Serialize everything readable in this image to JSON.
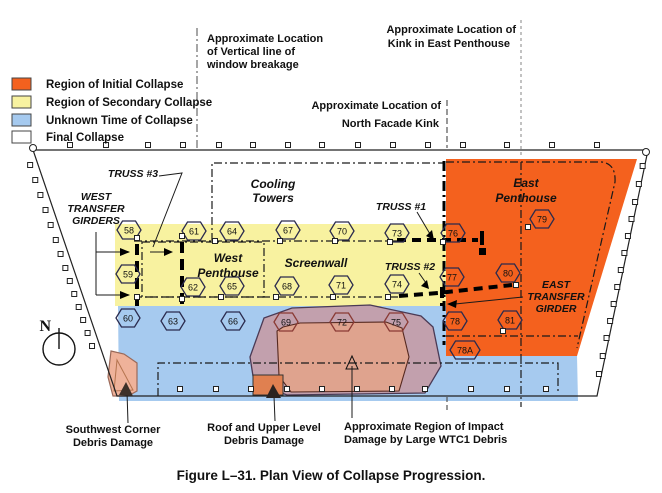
{
  "figure": {
    "caption": "Figure L–31.  Plan View of Collapse Progression."
  },
  "legend": {
    "items": [
      {
        "label": "Region of Initial Collapse",
        "color": "#F4611E"
      },
      {
        "label": "Region of Secondary Collapse",
        "color": "#F8F2A0"
      },
      {
        "label": "Unknown Time of Collapse",
        "color": "#A6CAEF"
      },
      {
        "label": "Final Collapse",
        "color": "#FFFFFF"
      }
    ]
  },
  "annotations": {
    "window_breakage": {
      "line1": "Approximate Location",
      "line2": "of Vertical line of",
      "line3": "window breakage"
    },
    "east_penthouse_kink": {
      "line1": "Approximate Location of",
      "line2": "Kink in East Penthouse"
    },
    "north_facade_kink": {
      "line1": "Approximate Location of",
      "line2": "North Facade Kink"
    }
  },
  "building": {
    "areas": {
      "cooling_towers": {
        "line1": "Cooling",
        "line2": "Towers"
      },
      "west_penthouse": {
        "line1": "West",
        "line2": "Penthouse"
      },
      "screenwall": "Screenwall",
      "east_penthouse": {
        "line1": "East",
        "line2": "Penthouse"
      }
    },
    "trusses": {
      "t1": "TRUSS #1",
      "t2": "TRUSS #2",
      "t3": "TRUSS #3"
    },
    "west_girders": {
      "line1": "WEST",
      "line2": "TRANSFER",
      "line3": "GIRDERS"
    },
    "east_girder": {
      "line1": "EAST",
      "line2": "TRANSFER",
      "line3": "GIRDER"
    },
    "columns": [
      {
        "n": "58",
        "x": 129,
        "y": 230
      },
      {
        "n": "61",
        "x": 194,
        "y": 231
      },
      {
        "n": "64",
        "x": 232,
        "y": 231
      },
      {
        "n": "67",
        "x": 288,
        "y": 230
      },
      {
        "n": "70",
        "x": 342,
        "y": 231
      },
      {
        "n": "73",
        "x": 397,
        "y": 233
      },
      {
        "n": "76",
        "x": 453,
        "y": 233
      },
      {
        "n": "79",
        "x": 542,
        "y": 219
      },
      {
        "n": "59",
        "x": 128,
        "y": 274
      },
      {
        "n": "62",
        "x": 193,
        "y": 287
      },
      {
        "n": "65",
        "x": 232,
        "y": 286
      },
      {
        "n": "68",
        "x": 287,
        "y": 286
      },
      {
        "n": "71",
        "x": 341,
        "y": 285
      },
      {
        "n": "74",
        "x": 397,
        "y": 284
      },
      {
        "n": "77",
        "x": 452,
        "y": 277
      },
      {
        "n": "80",
        "x": 508,
        "y": 273
      },
      {
        "n": "60",
        "x": 128,
        "y": 318
      },
      {
        "n": "63",
        "x": 173,
        "y": 321
      },
      {
        "n": "66",
        "x": 233,
        "y": 321
      },
      {
        "n": "69",
        "x": 286,
        "y": 322,
        "c": "#8a3a34"
      },
      {
        "n": "72",
        "x": 342,
        "y": 322,
        "c": "#8a3a34"
      },
      {
        "n": "75",
        "x": 396,
        "y": 322,
        "c": "#8a3a34"
      },
      {
        "n": "78",
        "x": 455,
        "y": 321
      },
      {
        "n": "81",
        "x": 510,
        "y": 320
      },
      {
        "n": "78A",
        "x": 465,
        "y": 350
      }
    ]
  },
  "damage": {
    "southwest": {
      "line1": "Southwest Corner",
      "line2": "Debris Damage"
    },
    "roof": {
      "line1": "Roof and Upper Level",
      "line2": "Debris Damage"
    },
    "impact": {
      "line1": "Approximate Region of Impact",
      "line2": "Damage by Large WTC1 Debris"
    }
  },
  "compass": {
    "label": "N"
  },
  "colors": {
    "initial": "#F4611E",
    "secondary": "#F8F2A0",
    "unknown": "#A6CAEF",
    "final": "#FFFFFF",
    "blob_outer": "#C2A0AD",
    "blob_inner": "#DFA38E",
    "corner_fill": "#EFB29A",
    "impact_rect": "#E08050"
  }
}
